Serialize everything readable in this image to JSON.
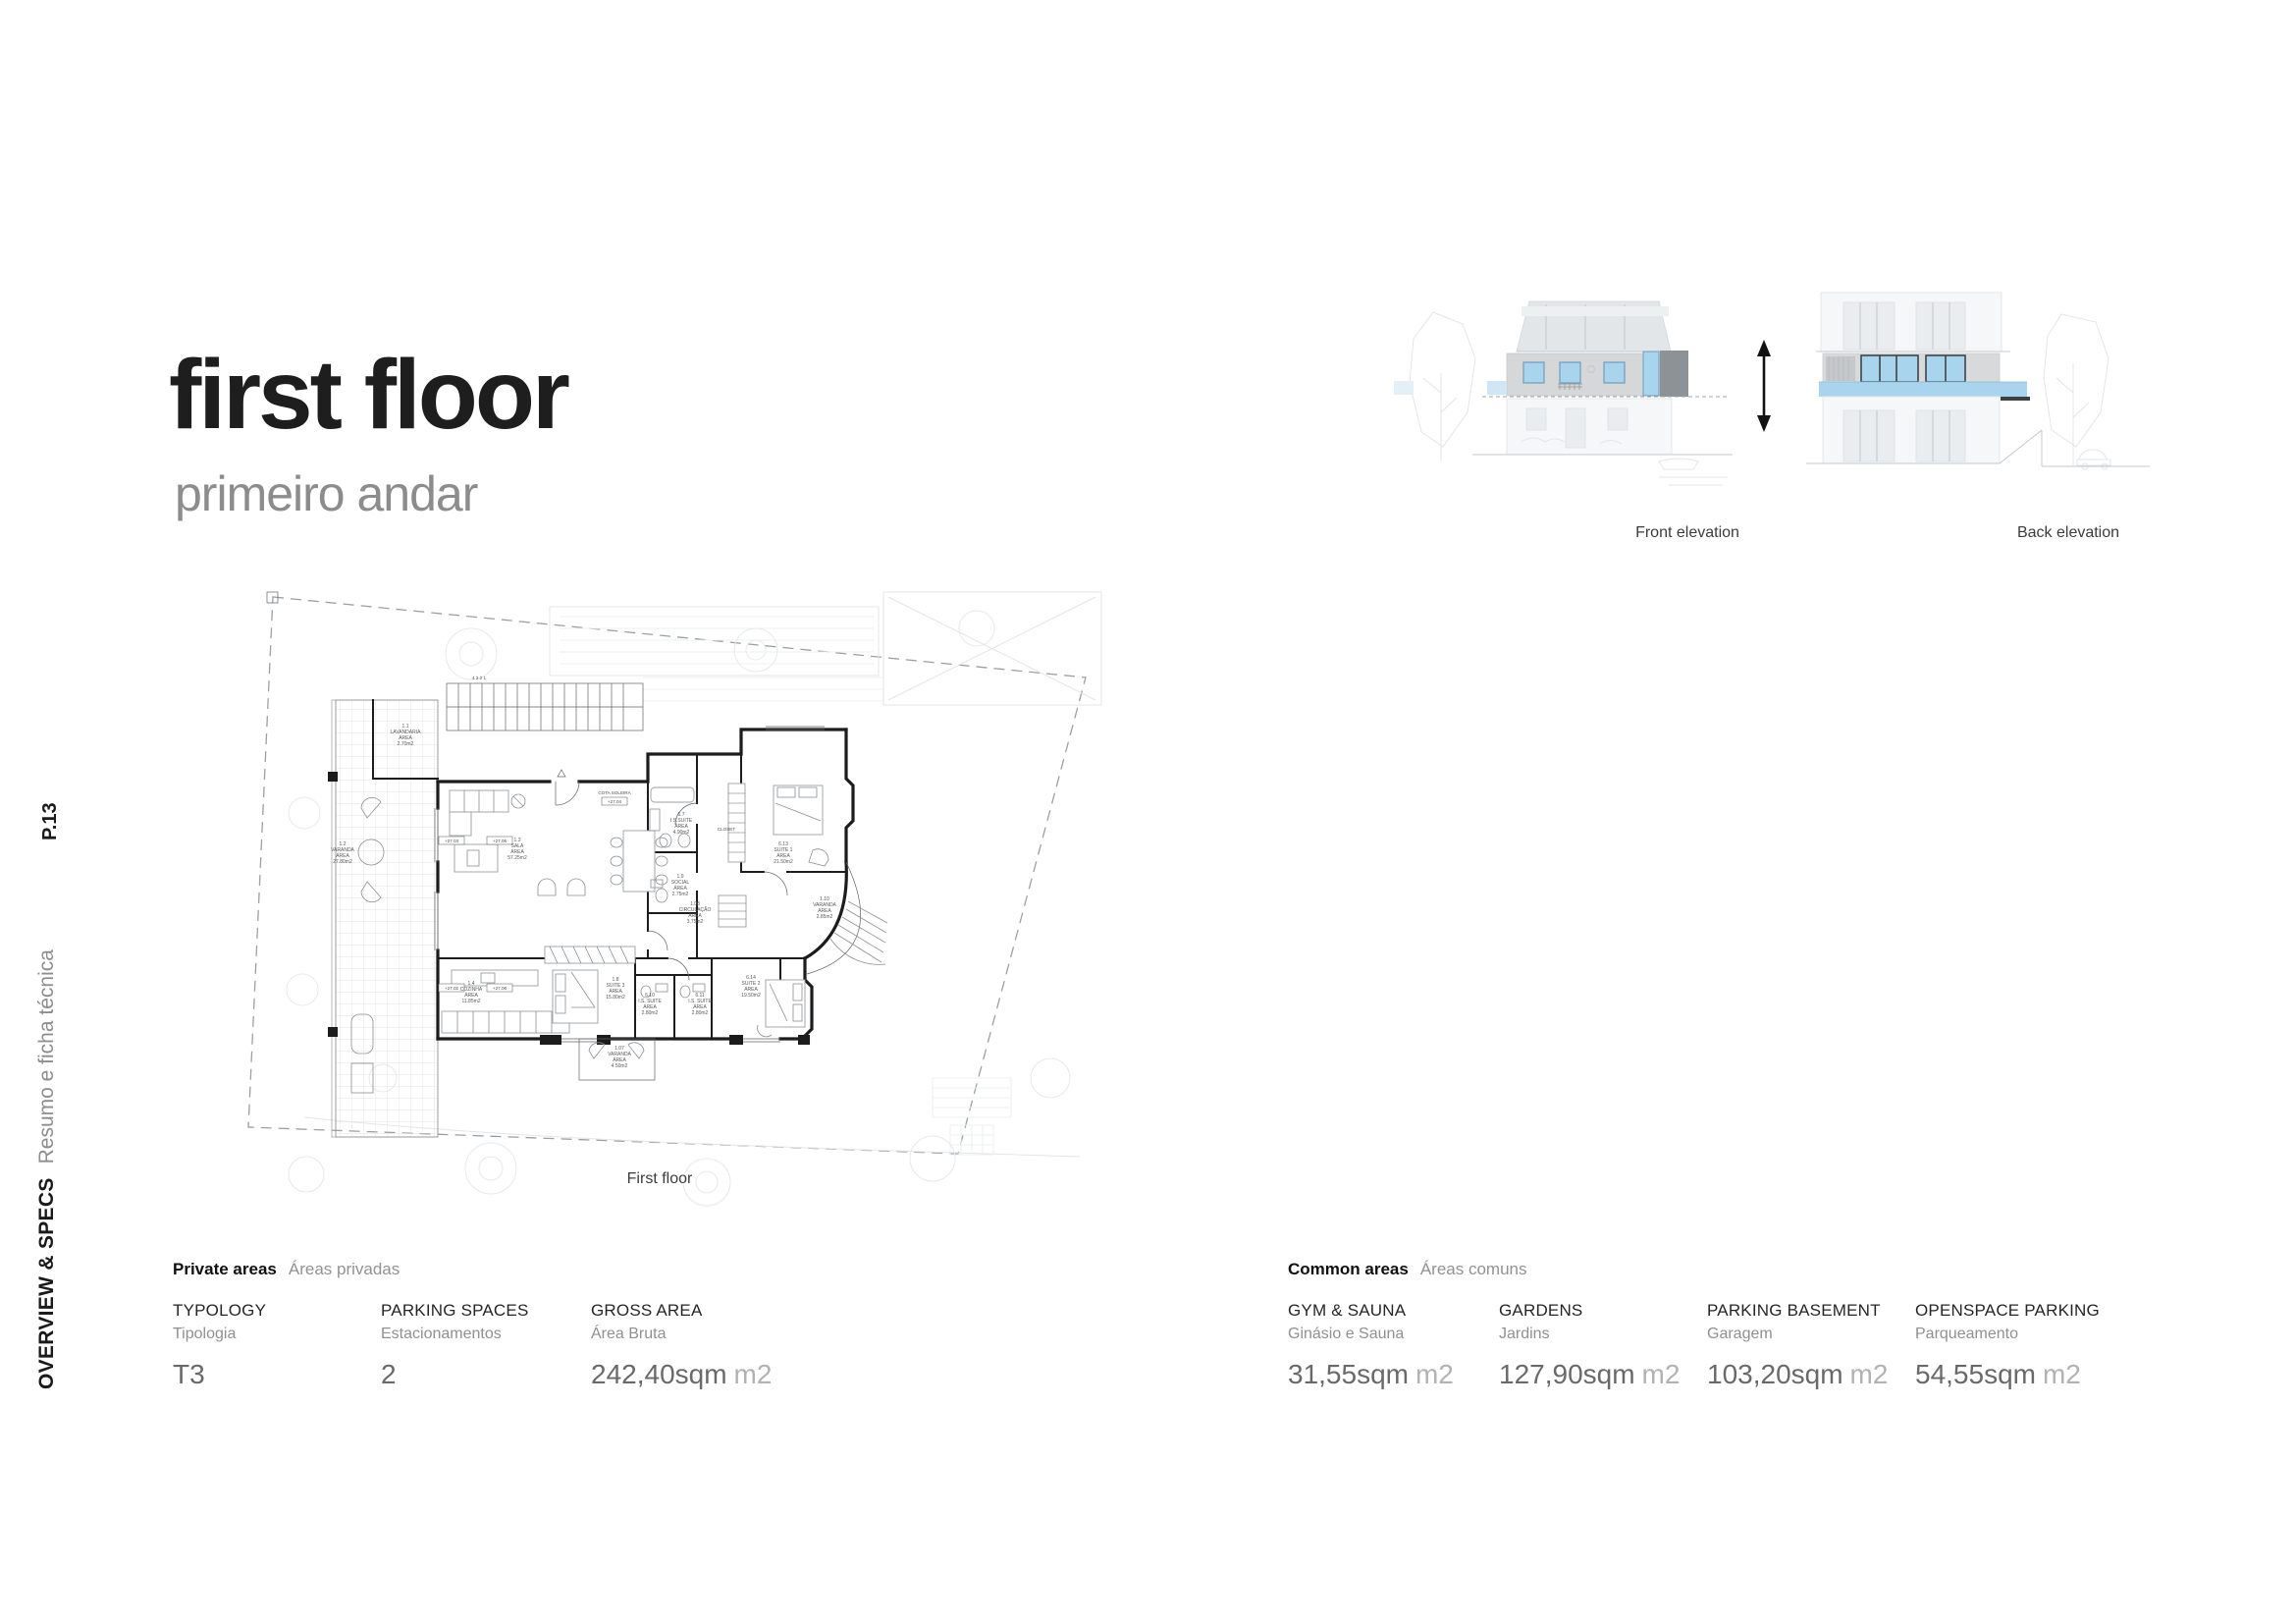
{
  "page": {
    "title": "first floor",
    "subtitle": "primeiro andar",
    "page_number": "P.13",
    "section_label": "OVERVIEW & SPECS",
    "section_sublabel": "Resumo e ficha técnica"
  },
  "elevations": {
    "front_label": "Front elevation",
    "back_label": "Back elevation"
  },
  "plan": {
    "caption": "First floor",
    "area_word": "ÁREA",
    "cota_label": "COTA SOLEIRA",
    "cota_value": "+27.04",
    "stair_numbers": "4  3  2  1",
    "closet_label": "CLOSET",
    "level_markers": [
      "+27.03",
      "+27.06",
      "+27.02",
      "+27.06"
    ],
    "rooms": [
      {
        "code": "1.1",
        "name": "LAVANDARIA",
        "area": "2.70m2"
      },
      {
        "code": "1.2",
        "name": "VARANDA",
        "area": "27.80m2"
      },
      {
        "code": "1.3",
        "name": "SALA",
        "area": "57.25m2"
      },
      {
        "code": "1.4",
        "name": "COZINHA",
        "area": "11.85m2"
      },
      {
        "code": "1.8",
        "name": "SUITE 3",
        "area": "15.80m2"
      },
      {
        "code": "6.10",
        "name": "I.S. SUITE",
        "area": "2.80m2"
      },
      {
        "code": "6.11",
        "name": "I.S. SUITE",
        "area": "2.80m2"
      },
      {
        "code": "6.14",
        "name": "SUITE 2",
        "area": "19.50m2"
      },
      {
        "code": "6.13",
        "name": "SUITE 1",
        "area": "21.50m2"
      },
      {
        "code": "6.7",
        "name": "I.S.SUITE",
        "area": "4.90m2"
      },
      {
        "code": "1.9",
        "name": "SOCIAL",
        "area": "2.75m2"
      },
      {
        "code": "1.08",
        "name": "CIRCULAÇÃO",
        "area": "3.75m2"
      },
      {
        "code": "1.10",
        "name": "VARANDA",
        "area": "2.85m2"
      },
      {
        "code": "1.07",
        "name": "VARANDA",
        "area": "4.50m2"
      }
    ]
  },
  "specs": {
    "private": {
      "title": "Private areas",
      "subtitle": "Áreas privadas",
      "items": [
        {
          "label": "TYPOLOGY",
          "sublabel": "Tipologia",
          "value": "T3",
          "unit": ""
        },
        {
          "label": "PARKING SPACES",
          "sublabel": "Estacionamentos",
          "value": "2",
          "unit": ""
        },
        {
          "label": "GROSS AREA",
          "sublabel": "Área Bruta",
          "value": "242,40sqm",
          "unit": "m2"
        }
      ]
    },
    "common": {
      "title": "Common areas",
      "subtitle": "Áreas comuns",
      "items": [
        {
          "label": "GYM & SAUNA",
          "sublabel": "Ginásio e Sauna",
          "value": "31,55sqm",
          "unit": "m2"
        },
        {
          "label": "GARDENS",
          "sublabel": "Jardins",
          "value": "127,90sqm",
          "unit": "m2"
        },
        {
          "label": "PARKING BASEMENT",
          "sublabel": "Garagem",
          "value": "103,20sqm",
          "unit": "m2"
        },
        {
          "label": "OPENSPACE PARKING",
          "sublabel": "Parqueamento",
          "value": "54,55sqm",
          "unit": "m2"
        }
      ]
    }
  },
  "colors": {
    "accent_blue": "#a9d4ee",
    "accent_blue_light": "#cfe6f4",
    "elevation_band_gray": "#d6d7d8",
    "elevation_dark_gray": "#8d9297",
    "frame_dark": "#3f4447"
  }
}
